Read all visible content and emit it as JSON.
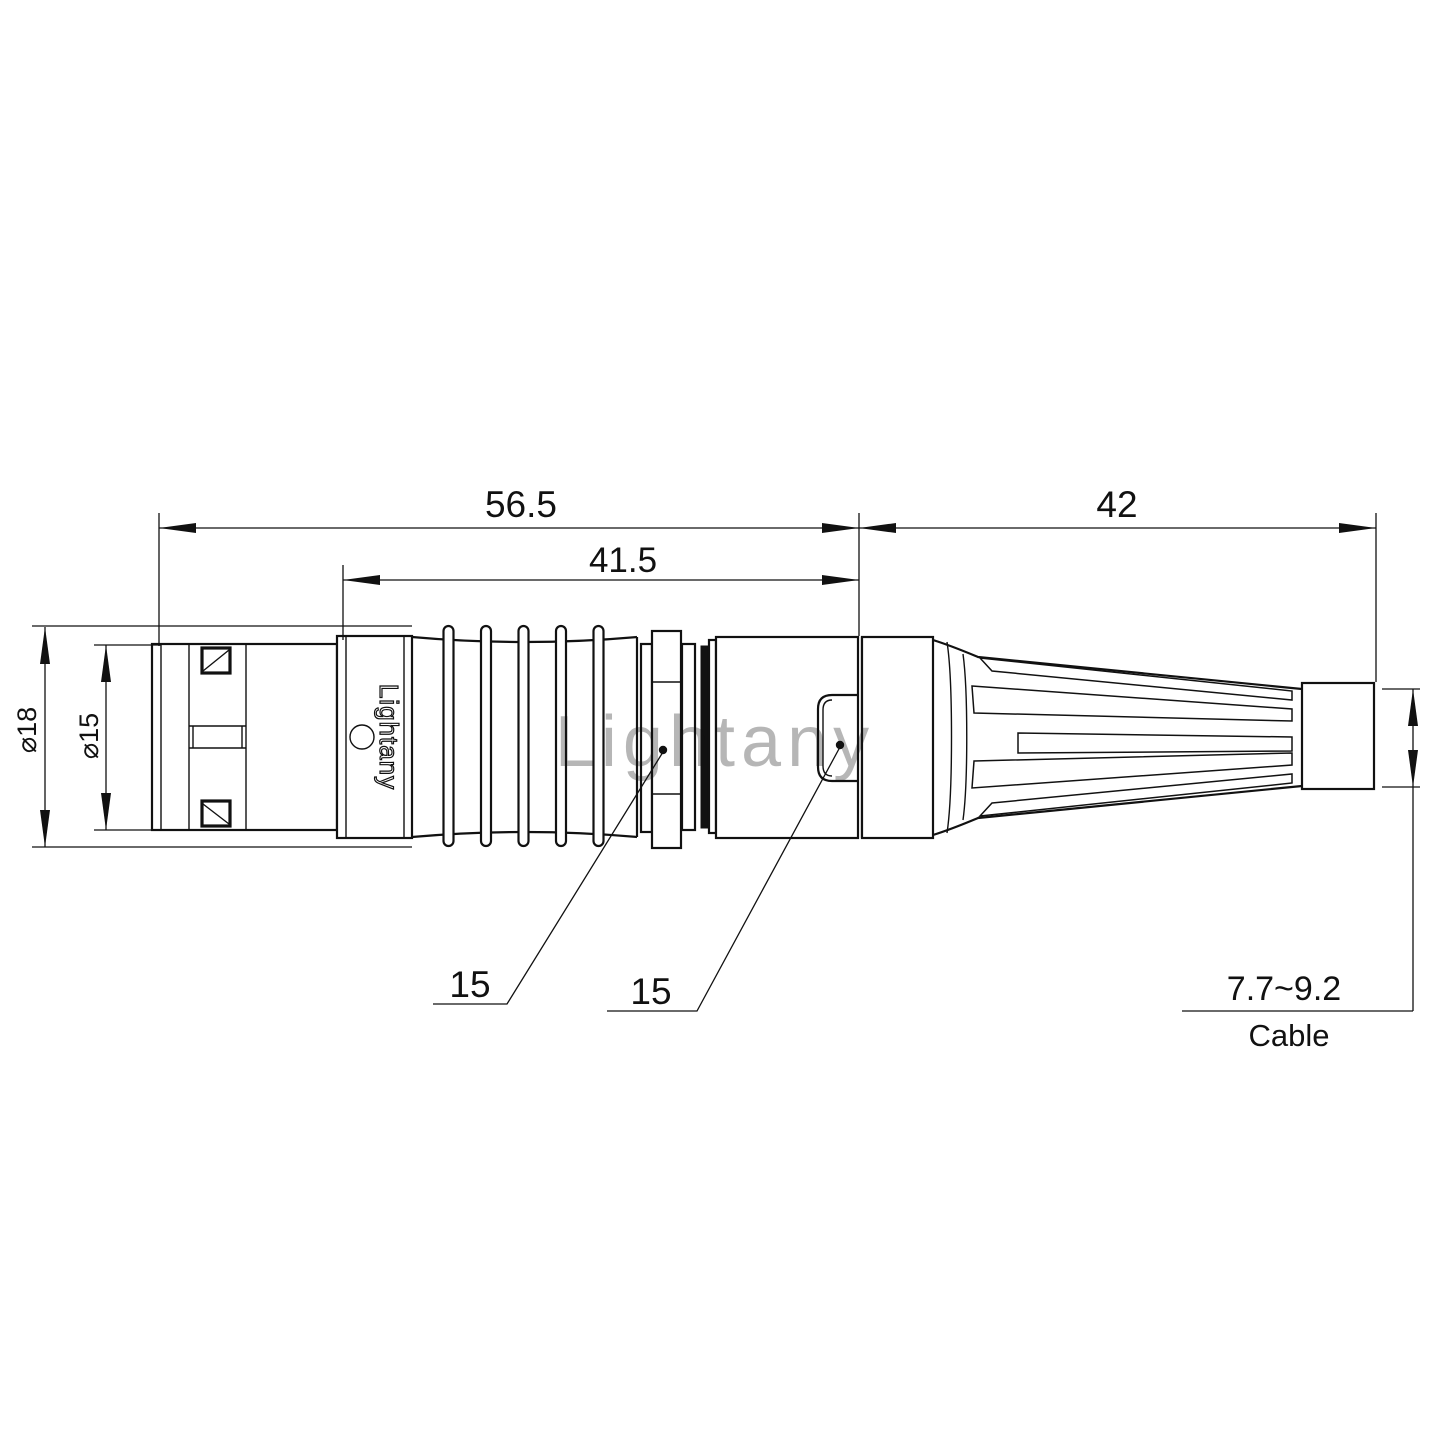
{
  "title": "Circular push-pull connector with cable boot - dimensioned technical drawing",
  "marking": "Lightany",
  "watermark": "Lightany",
  "dims": {
    "overall_length": "56.5",
    "body_length": "41.5",
    "boot_length": "42",
    "dia_outer": "⌀18",
    "dia_front": "⌀15",
    "leader_left": "15",
    "leader_right": "15",
    "cable_range": "7.7~9.2",
    "cable_word": "Cable"
  },
  "colors": {
    "line": "#111111",
    "watermark": "#dd7777",
    "background": "#ffffff"
  }
}
